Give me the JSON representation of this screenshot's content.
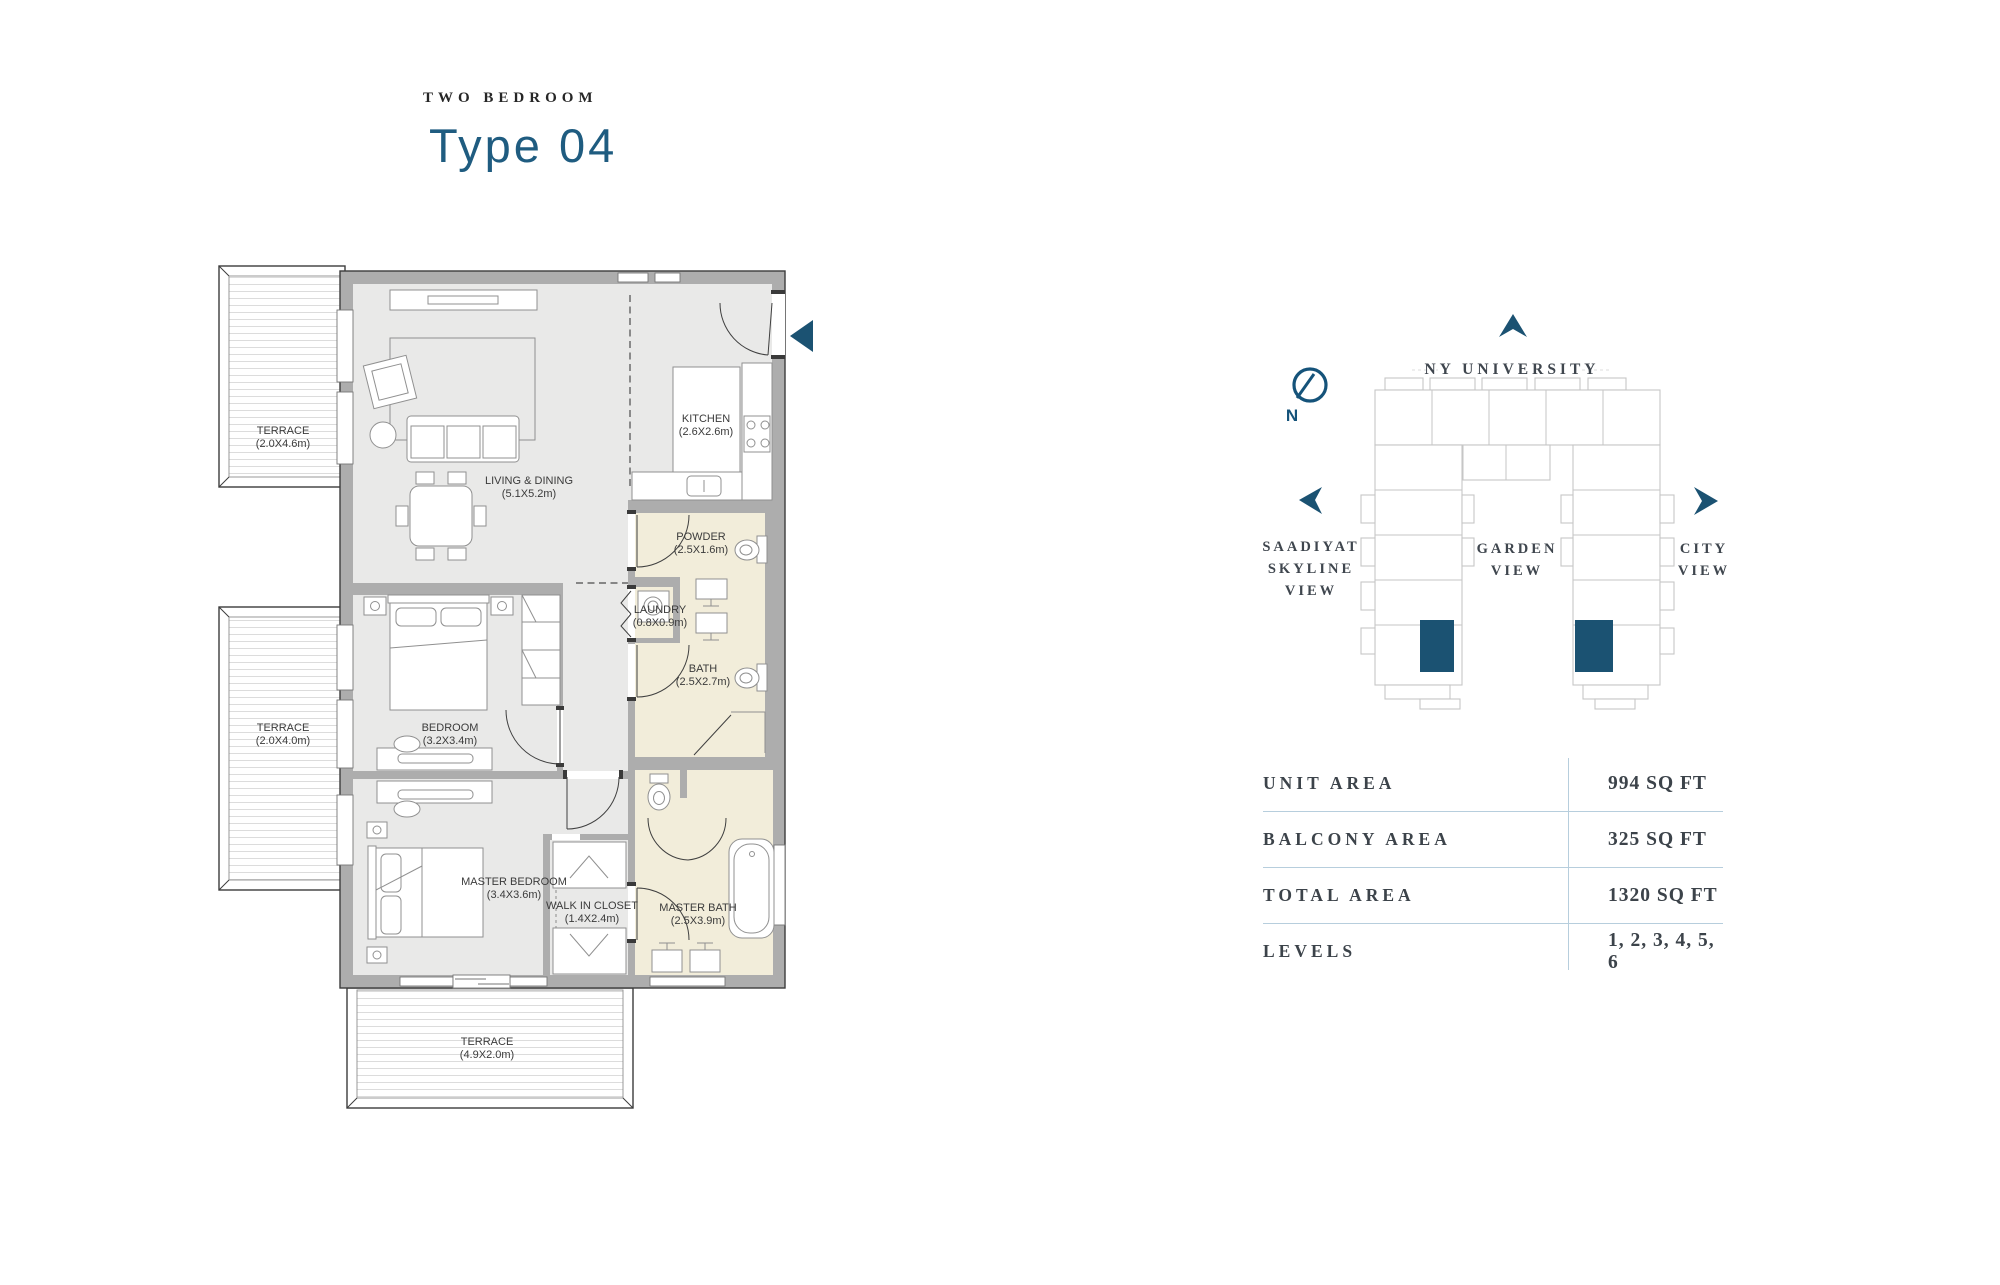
{
  "header": {
    "category": "TWO BEDROOM",
    "title": "Type 04"
  },
  "floorplan": {
    "rooms": [
      {
        "id": "terrace-1",
        "name": "TERRACE",
        "dims": "(2.0X4.6m)"
      },
      {
        "id": "terrace-2",
        "name": "TERRACE",
        "dims": "(2.0X4.0m)"
      },
      {
        "id": "terrace-3",
        "name": "TERRACE",
        "dims": "(4.9X2.0m)"
      },
      {
        "id": "living-dining",
        "name": "LIVING & DINING",
        "dims": "(5.1X5.2m)"
      },
      {
        "id": "kitchen",
        "name": "KITCHEN",
        "dims": "(2.6X2.6m)"
      },
      {
        "id": "powder",
        "name": "POWDER",
        "dims": "(2.5X1.6m)"
      },
      {
        "id": "laundry",
        "name": "LAUNDRY",
        "dims": "(0.8X0.9m)"
      },
      {
        "id": "bath",
        "name": "BATH",
        "dims": "(2.5X2.7m)"
      },
      {
        "id": "bedroom",
        "name": "BEDROOM",
        "dims": "(3.2X3.4m)"
      },
      {
        "id": "master-bedroom",
        "name": "MASTER BEDROOM",
        "dims": "(3.4X3.6m)"
      },
      {
        "id": "walk-in-closet",
        "name": "WALK IN CLOSET",
        "dims": "(1.4X2.4m)"
      },
      {
        "id": "master-bath",
        "name": "MASTER BATH",
        "dims": "(2.5X3.9m)"
      }
    ],
    "colors": {
      "wall": "#adadad",
      "floor": "#e9e9e8",
      "wet_area": "#f2edda",
      "accent": "#1b5272"
    }
  },
  "site": {
    "compass_label": "N",
    "landmark": "NY UNIVERSITY",
    "views": {
      "west": {
        "line1": "SAADIYAT",
        "line2": "SKYLINE",
        "line3": "VIEW"
      },
      "center": {
        "line1": "GARDEN",
        "line2": "VIEW"
      },
      "east": {
        "line1": "CITY",
        "line2": "VIEW"
      }
    },
    "highlight_color": "#1b5272"
  },
  "details": {
    "divider_color": "#b7cedd",
    "rows": [
      {
        "label": "UNIT AREA",
        "value": "994 SQ FT"
      },
      {
        "label": "BALCONY AREA",
        "value": "325 SQ FT"
      },
      {
        "label": "TOTAL AREA",
        "value": "1320 SQ FT"
      },
      {
        "label": "LEVELS",
        "value": "1, 2, 3, 4, 5, 6"
      }
    ]
  }
}
